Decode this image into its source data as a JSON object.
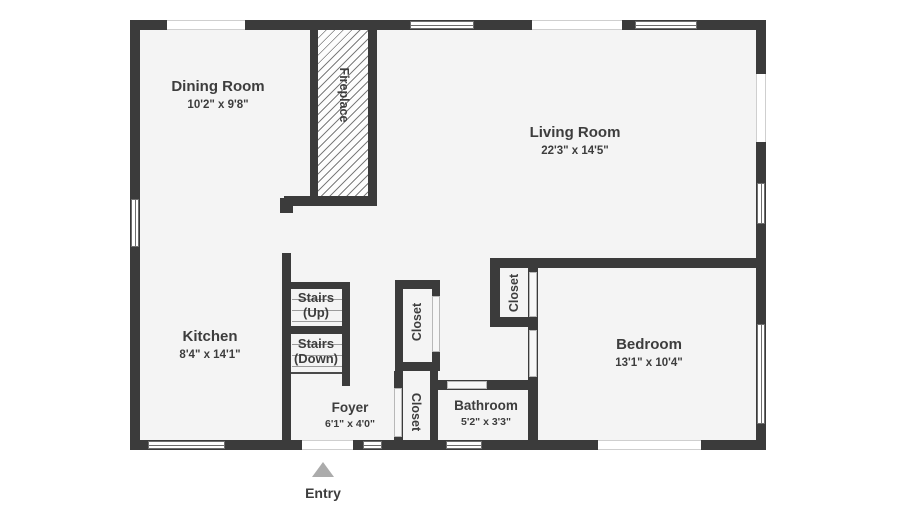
{
  "plan": {
    "title": "Floor plan",
    "rooms": [
      {
        "id": "dining",
        "name": "Dining Room",
        "dims": "10'2\" x 9'8\""
      },
      {
        "id": "living",
        "name": "Living Room",
        "dims": "22'3\" x 14'5\""
      },
      {
        "id": "kitchen",
        "name": "Kitchen",
        "dims": "8'4\" x 14'1\""
      },
      {
        "id": "foyer",
        "name": "Foyer",
        "dims": "6'1\" x 4'0\""
      },
      {
        "id": "bathroom",
        "name": "Bathroom",
        "dims": "5'2\" x 3'3\""
      },
      {
        "id": "bedroom",
        "name": "Bedroom",
        "dims": "13'1\" x 10'4\""
      }
    ],
    "stairs_up": {
      "line1": "Stairs",
      "line2": "(Up)"
    },
    "stairs_down": {
      "line1": "Stairs",
      "line2": "(Down)"
    },
    "closets": {
      "upper": "Closet",
      "lower": "Closet",
      "bedroom": "Closet"
    },
    "fireplace_label": "Fireplace",
    "entry_label": "Entry",
    "colors": {
      "wall": "#3b3b3b",
      "floor": "#f4f4f4",
      "text": "#3d3d3d",
      "entry_arrow": "#ababab"
    }
  }
}
